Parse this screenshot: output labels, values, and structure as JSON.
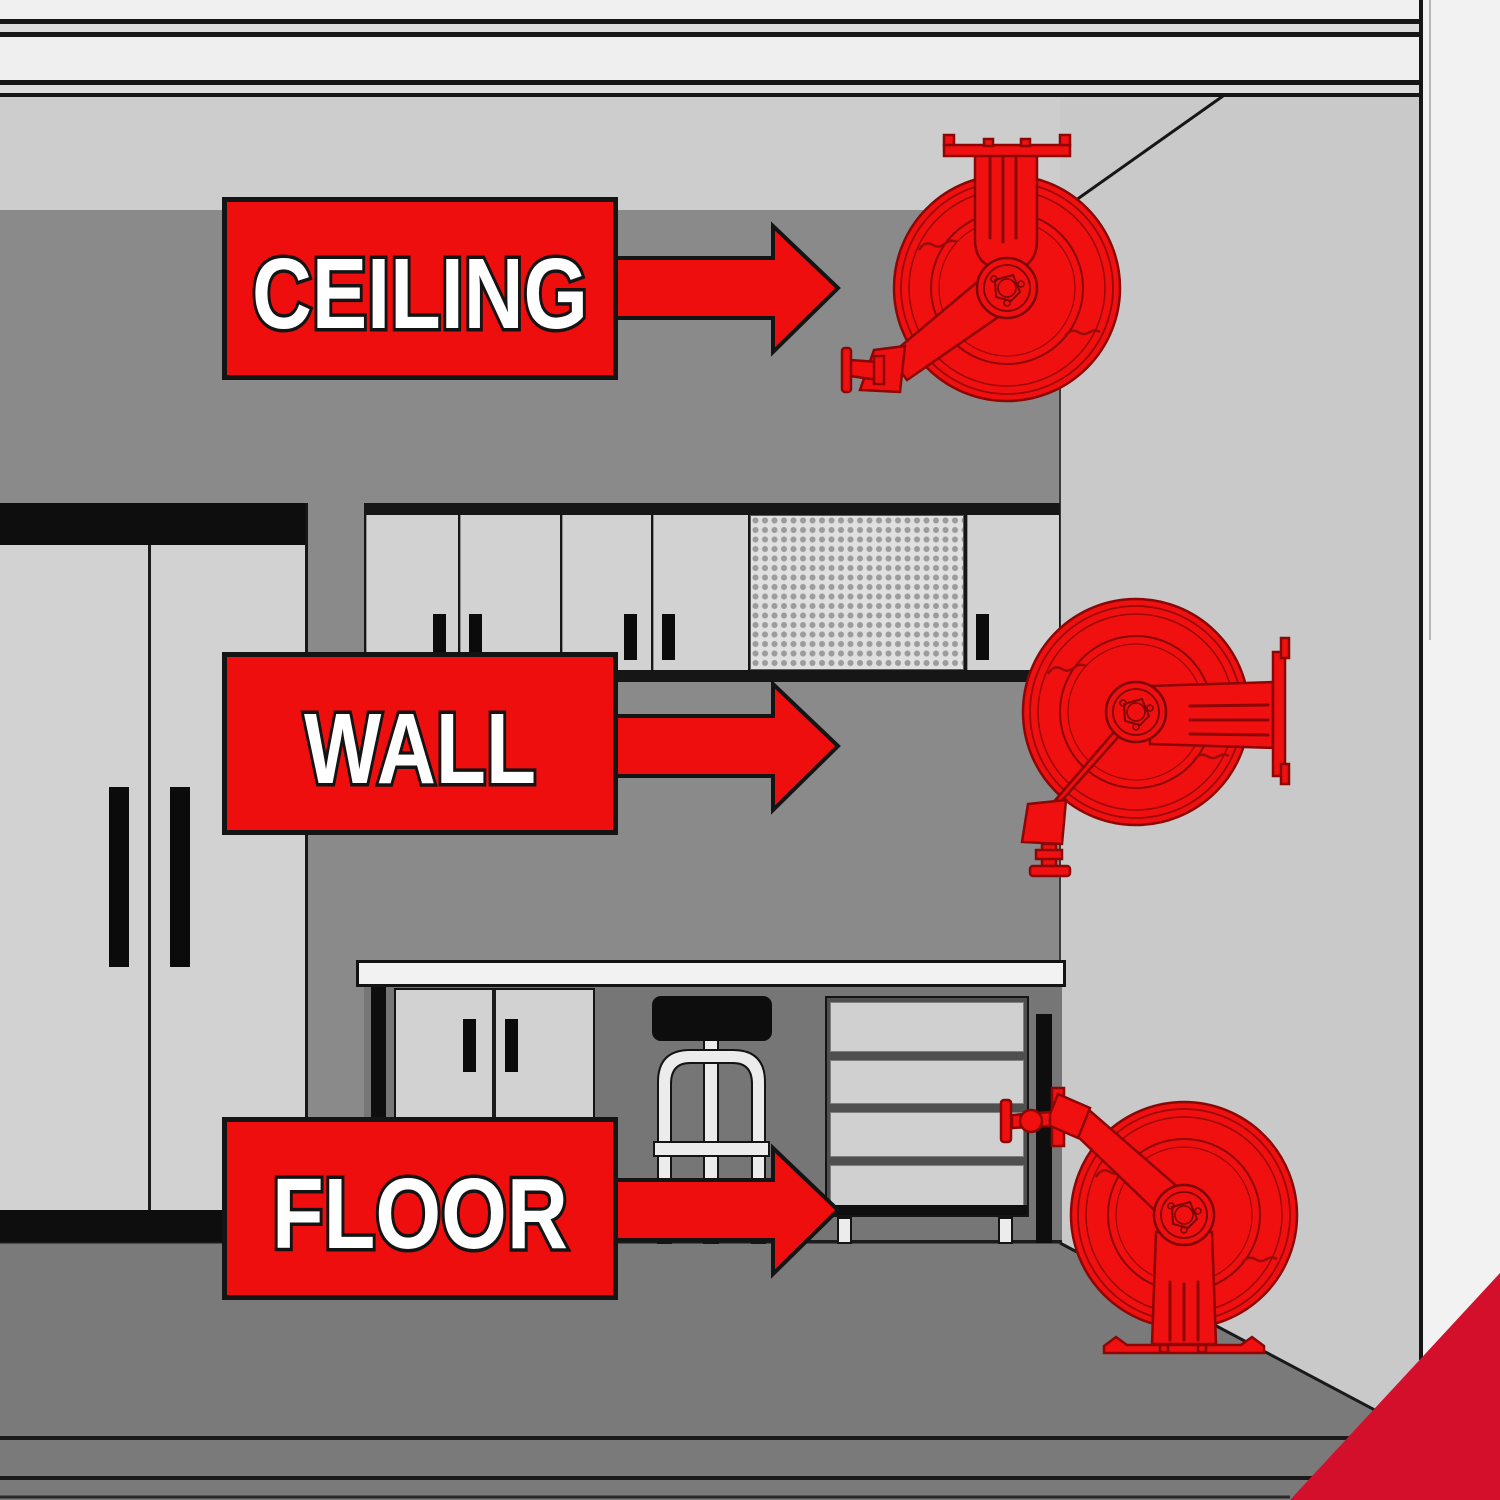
{
  "labels": [
    {
      "id": "ceiling",
      "text": "CEILING"
    },
    {
      "id": "wall",
      "text": "WALL"
    },
    {
      "id": "floor",
      "text": "FLOOR"
    }
  ],
  "reels": [
    {
      "name": "ceiling-mounted-hose-reel",
      "mount": "ceiling"
    },
    {
      "name": "wall-mounted-hose-reel",
      "mount": "wall"
    },
    {
      "name": "floor-mounted-hose-reel",
      "mount": "floor"
    }
  ],
  "colors": {
    "reel_red": "#f01010",
    "label_red": "#ee0e0e",
    "corner_red": "#d40f2c",
    "outline_black": "#141414",
    "back_wall_gray": "#8a8a8a",
    "upper_wall_gray": "#cdcdcd",
    "right_wall_gray": "#c9c9c9",
    "under_bench_gray": "#767676",
    "floor_gray": "#7a7a7a",
    "cabinet_gray": "#d2d2d2",
    "counter_white": "#f2f2f2"
  }
}
